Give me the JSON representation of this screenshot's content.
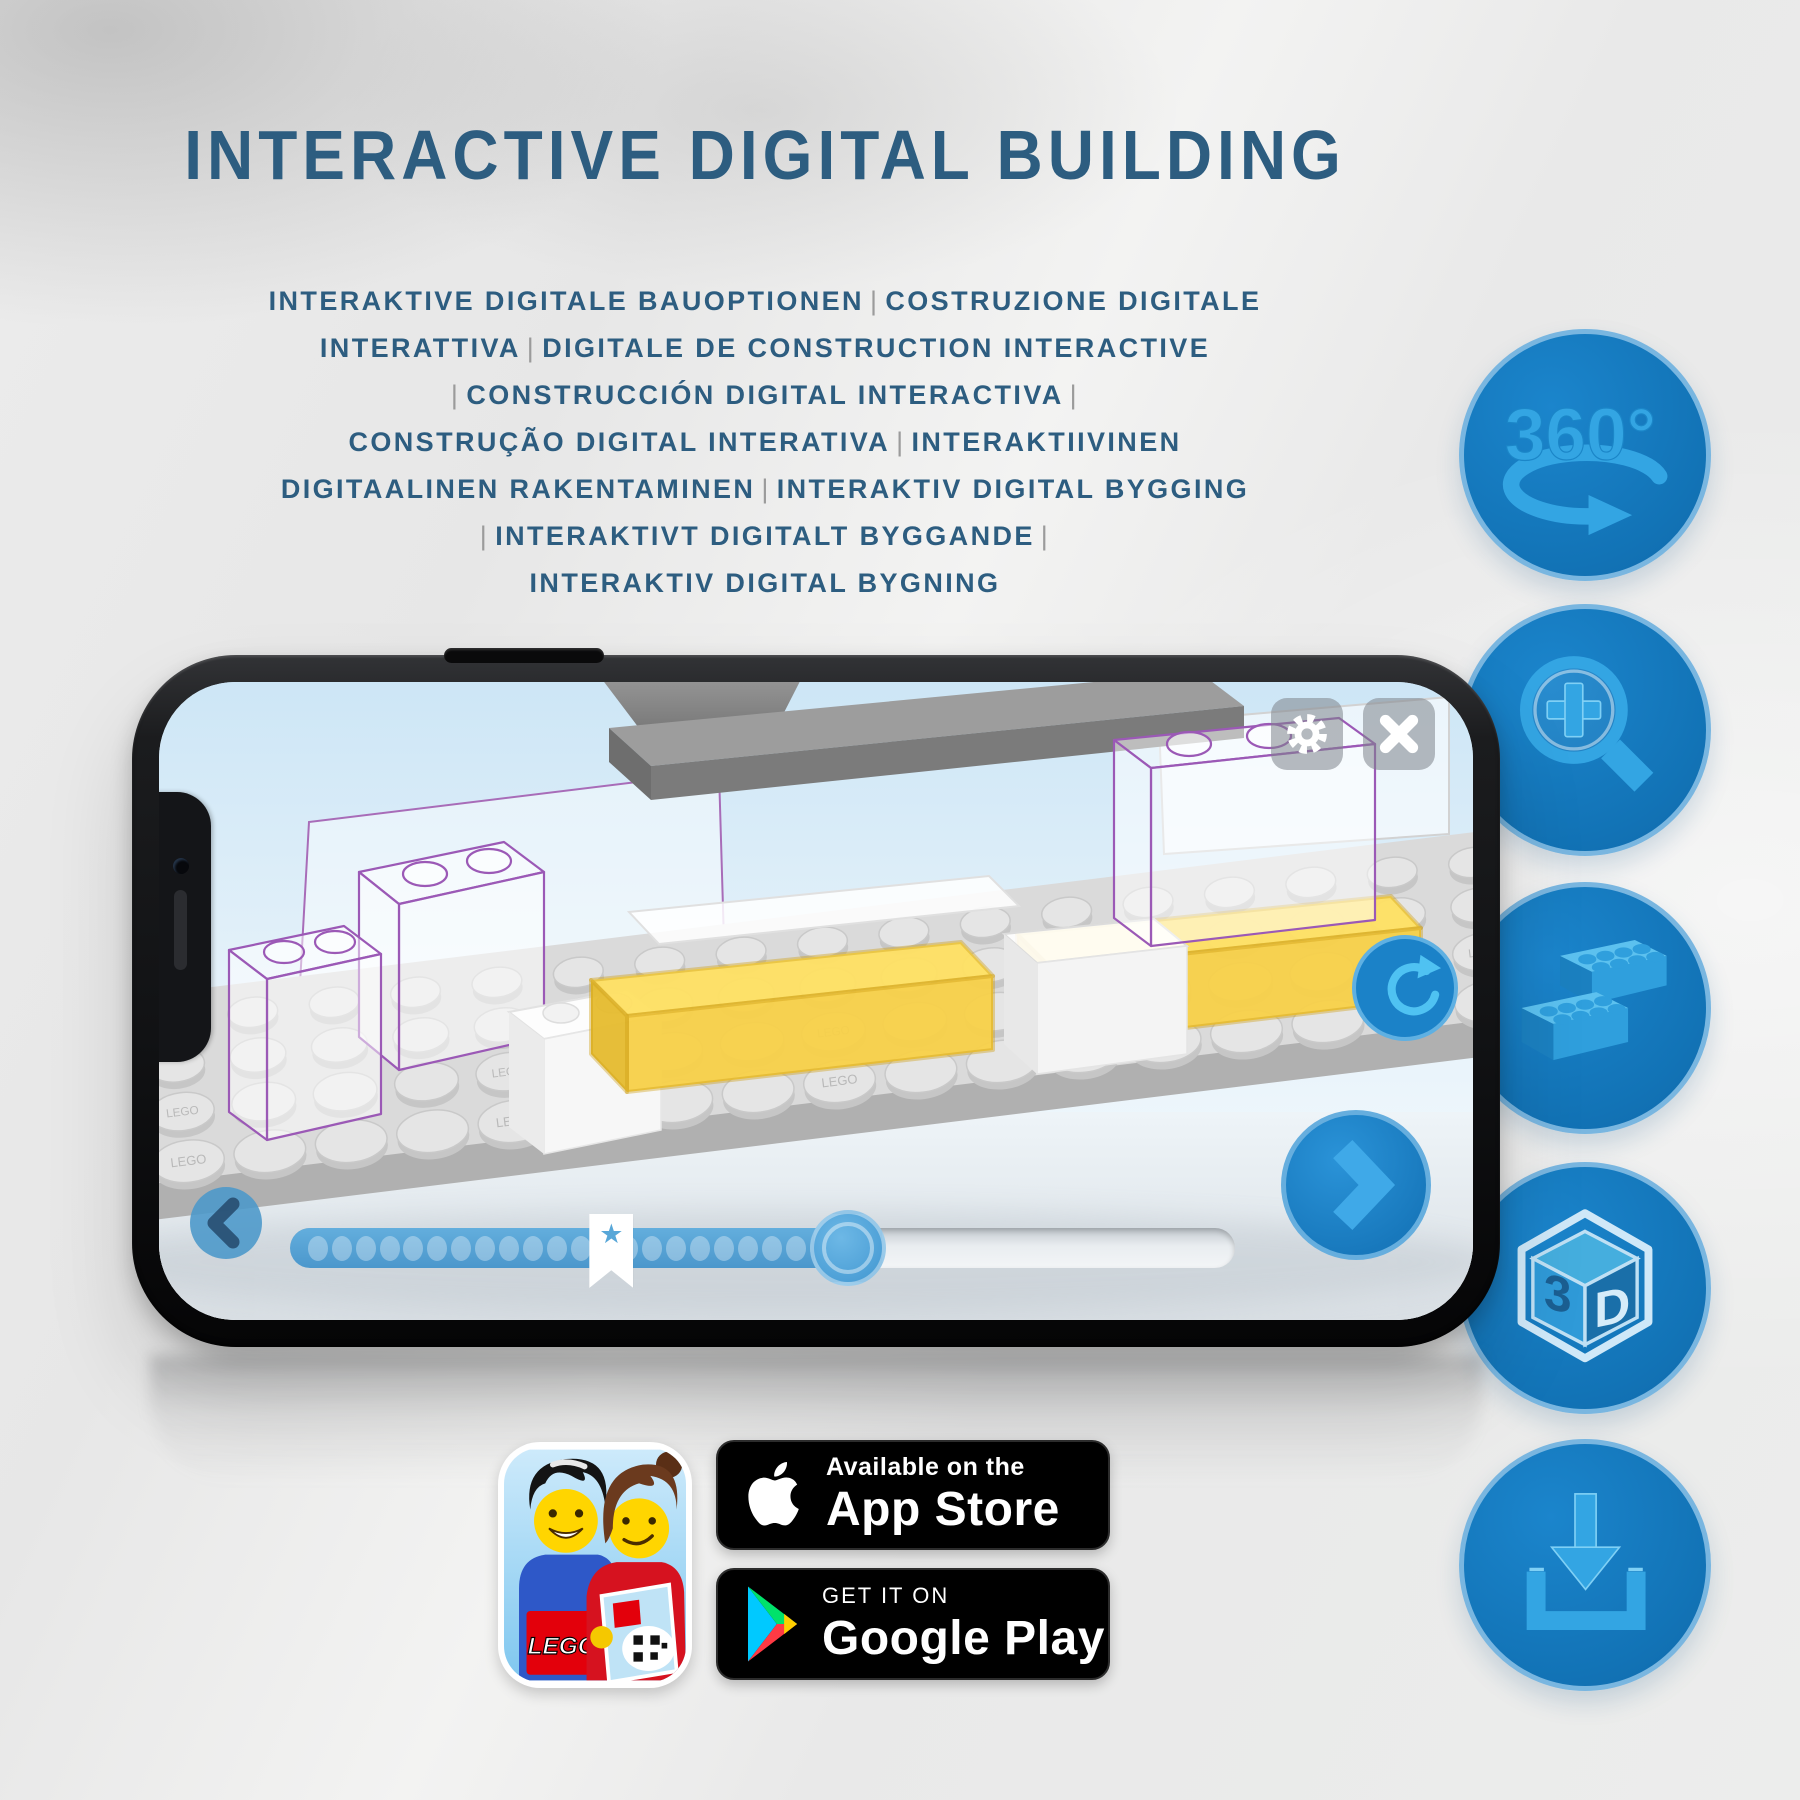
{
  "title": "INTERACTIVE DIGITAL BUILDING",
  "subtitle_lines": [
    "INTERAKTIVE DIGITALE BAUOPTIONEN | COSTRUZIONE DIGITALE",
    "INTERATTIVA | DIGITALE DE CONSTRUCTION INTERACTIVE",
    "| CONSTRUCCIÓN DIGITAL INTERACTIVA |",
    "CONSTRUÇÃO DIGITAL INTERATIVA | INTERAKTIIVINEN",
    "DIGITAALINEN RAKENTAMINEN | INTERAKTIV DIGITAL BYGGING",
    "| INTERAKTIVT DIGITALT BYGGANDE |",
    "INTERAKTIV DIGITAL BYGNING"
  ],
  "feature_icons": {
    "rotation_label": "360°",
    "threed_left": "3",
    "threed_right": "D"
  },
  "phone": {
    "scene": {
      "stud_emboss": "LEGO"
    },
    "progress": {
      "dot_count": 22,
      "filled_pct": 59,
      "bookmark_pct": 34
    }
  },
  "store_badges": {
    "app_store": {
      "line1": "Available on the",
      "line2": "App Store"
    },
    "google_play": {
      "line1": "GET IT ON",
      "line2": "Google Play"
    }
  },
  "app_icon": {
    "lego_logo": "LEGO"
  },
  "colors": {
    "heading_blue": "#2d5d80",
    "separator_gray": "#9b9b9b",
    "icon_circle_blue": "#1477bd",
    "icon_glyph_blue": "#33a5e3",
    "highlight_yellow": "#f8d149",
    "ghost_outline_purple": "#9b59b6",
    "badge_black": "#000000"
  }
}
